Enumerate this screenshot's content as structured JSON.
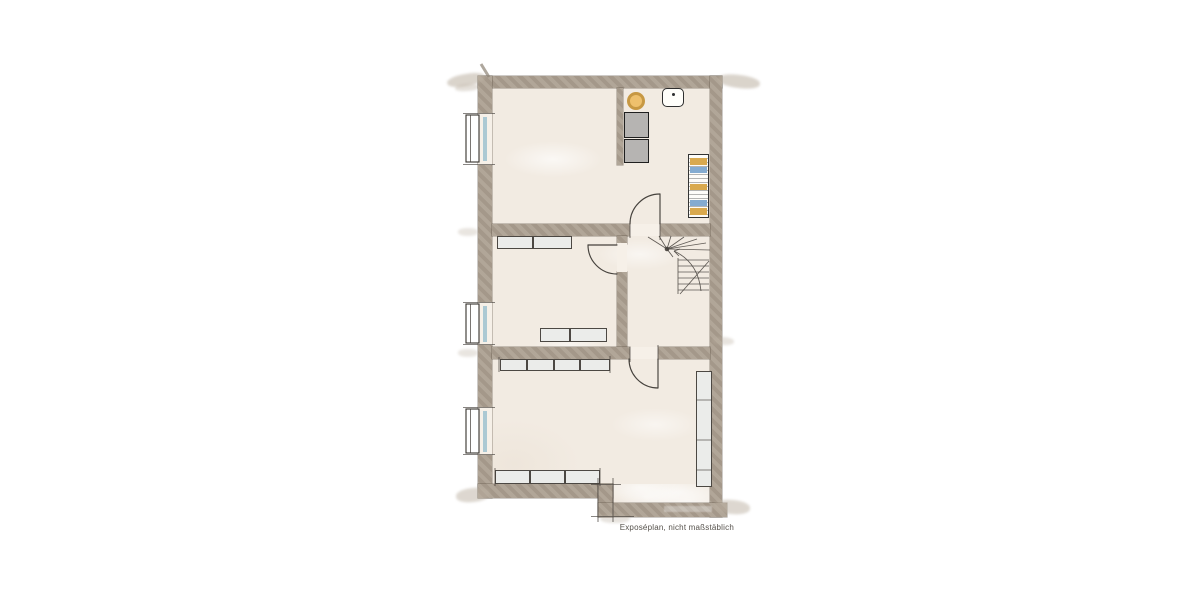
{
  "disclaimer": "Exposéplan, nicht maßstäblich",
  "plan": {
    "type": "floor-plan",
    "style": "hand-drawn-watercolor",
    "windows_count": 3,
    "doors_count": 3,
    "staircase": "winder-stairs-top-right-of-hall",
    "rooms": [
      {
        "name": "room-top",
        "fixtures": [
          "round-fixture",
          "washbasin",
          "appliance-1",
          "appliance-2",
          "striped-shelf",
          "partial-wall"
        ]
      },
      {
        "name": "room-middle-left",
        "fixtures": [
          "door",
          "cabinet-row-top",
          "cabinet-row-bottom"
        ]
      },
      {
        "name": "stair-hall",
        "fixtures": [
          "winder-staircase"
        ]
      },
      {
        "name": "room-bottom",
        "fixtures": [
          "door",
          "cabinet-row-top",
          "cabinet-row-bottom",
          "tall-wardrobe"
        ]
      }
    ],
    "colors": {
      "wall": "#ab9f90",
      "floor": "#f2ebe2",
      "threshold": "#f6f0e8",
      "line": "#45413c",
      "furniture_fill": "#ebecea",
      "appliance_fill": "#b6b4b2",
      "stool_fill": "#eec06d",
      "stool_stroke": "#c79843",
      "glass": "#9fc2cf",
      "shelf_gold": "#d9a94e",
      "shelf_blue": "#84abd0",
      "text": "#55514b"
    }
  }
}
